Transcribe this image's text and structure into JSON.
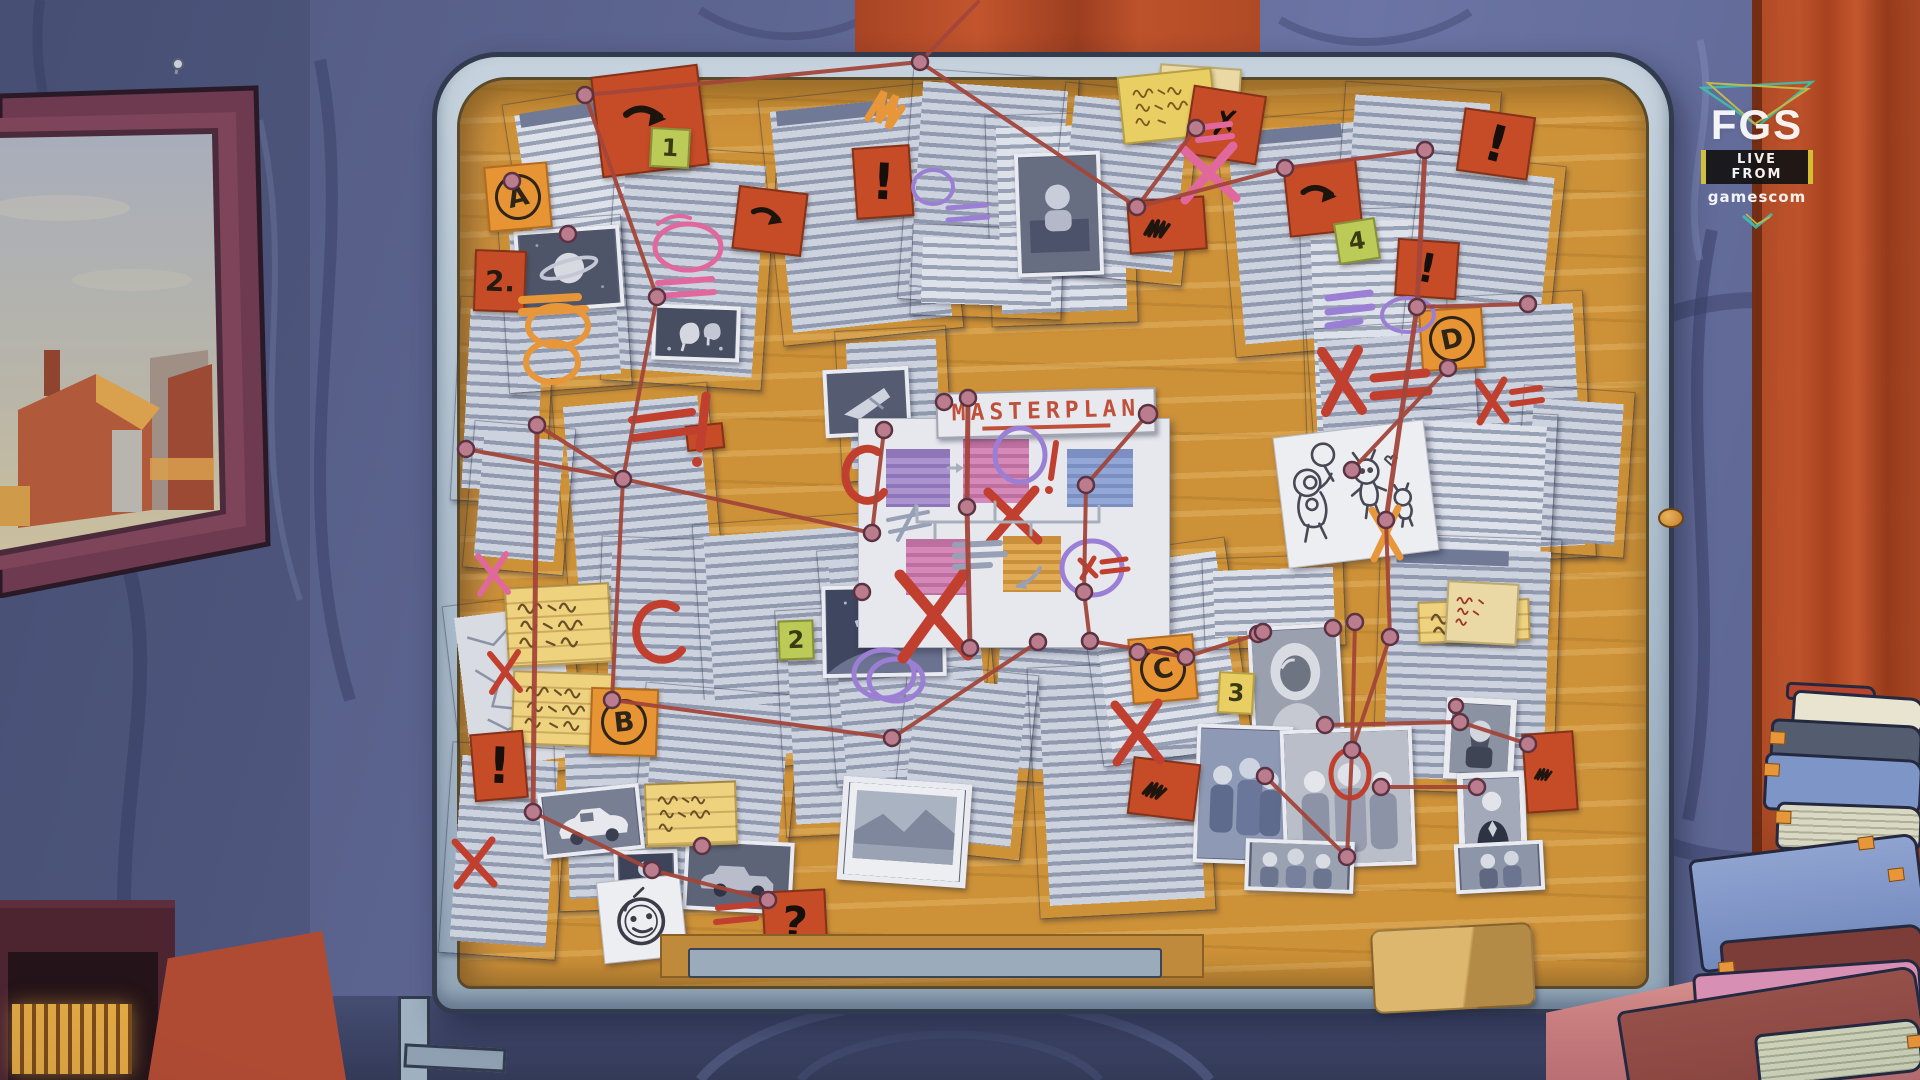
{
  "scene": {
    "setting": "animated room with detective corkboard",
    "board": {
      "title": "MASTERPLAN",
      "note_labels": {
        "a": "A",
        "b": "B",
        "c": "C",
        "d": "D",
        "one": "1",
        "two": "2",
        "three": "3",
        "four": "4",
        "two_dot": "2.",
        "exclaim": "!",
        "question": "?",
        "cross": "✗"
      }
    },
    "watermark": {
      "logo": "FGS",
      "tagline": "LIVE FROM",
      "brand": "gamescom"
    },
    "palette": {
      "wall": "#5e6794",
      "cork": "#cd9138",
      "frame": "#b9c7d4",
      "string": "#a3463a",
      "curtain": "#bf4f2a",
      "note_red": "#c64b27",
      "note_orange": "#e79434",
      "note_green": "#bcca58",
      "note_yellow": "#e9cf63",
      "marker_pink": "#e0689d",
      "marker_red": "#c13f2e",
      "marker_purple": "#9b7fd4",
      "marker_orange": "#e8963a"
    }
  }
}
